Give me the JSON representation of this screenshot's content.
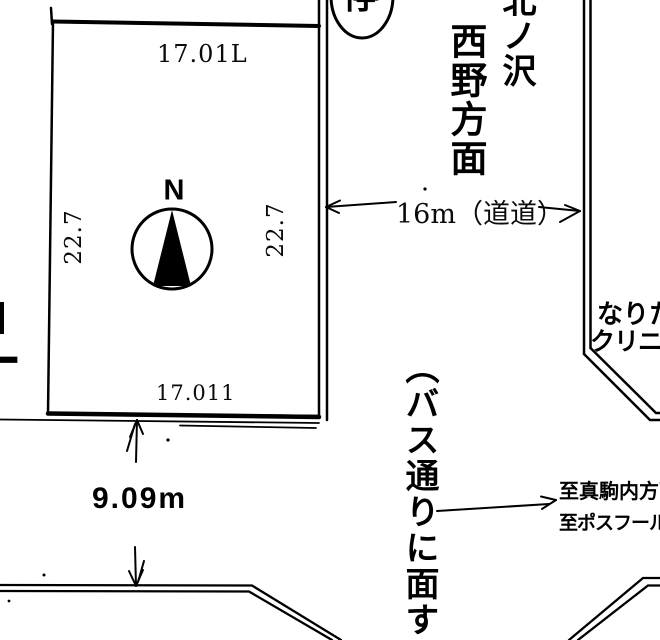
{
  "plot": {
    "dim_top": "17.01L",
    "dim_bottom": "17.011",
    "dim_left": "22.7",
    "dim_right": "22.7",
    "frontage": "9.09m"
  },
  "compass": {
    "north_label": "N"
  },
  "bus_stop_label": "停",
  "roads": {
    "width_label": "16m（道道）",
    "bus_street_label": "（バス通りに面す",
    "direction_label_col1": "北ノ沢",
    "direction_label_col2": "西野方面",
    "dest_line1": "至真駒内方面",
    "dest_line2": "至ポスフール方面"
  },
  "landmarks": {
    "clinic_line1": "なりた",
    "clinic_line2": "クリニック"
  },
  "edge_fragment": "丁",
  "colors": {
    "ink": "#000000",
    "paper": "#ffffff"
  }
}
